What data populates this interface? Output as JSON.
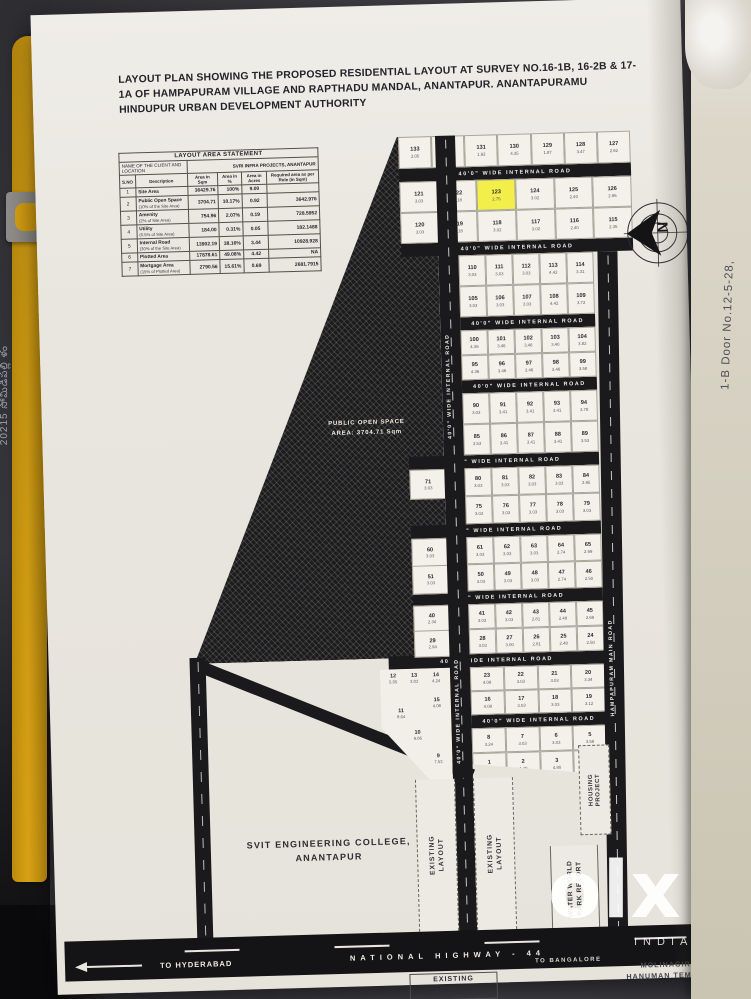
{
  "photo": {
    "left_margin_text": "20215 సోమిడిపల్లి ళం",
    "right_margin_text": "1-B Door No.12-5-28,",
    "watermark": {
      "brand": "olx",
      "country": "INDIA"
    }
  },
  "header": {
    "title": "LAYOUT PLAN SHOWING THE PROPOSED RESIDENTIAL LAYOUT AT SURVEY NO.16-1B, 16-2B & 17-1A OF HAMPAPURAM VILLAGE AND RAPTHADU MANDAL, ANANTAPUR.  ANANTAPURAMU HINDUPUR URBAN DEVELOPMENT AUTHORITY"
  },
  "table": {
    "title": "LAYOUT AREA STATEMENT",
    "client_label": "NAME OF THE CLIENT AND LOCATION",
    "client_value": "SVRI INFRA PROJECTS, ANANTAPUR",
    "columns": [
      "S.NO",
      "Description",
      "Area in Sqm",
      "Area in %",
      "Area in Acres",
      "Required area as per Rule (in Sqm)"
    ],
    "rows": [
      [
        "1",
        "Site Area",
        "36429.76",
        "100%",
        "9.00",
        ""
      ],
      [
        "2",
        "Public Open Space|(10% of the Site Area)",
        "3704.71",
        "10.17%",
        "0.92",
        "3642.976"
      ],
      [
        "3",
        "Amenity|(2% of Site Area)",
        "754.96",
        "2.07%",
        "0.19",
        "728.5952"
      ],
      [
        "4",
        "Utility|(0.5% of Site Area)",
        "184.00",
        "0.31%",
        "0.05",
        "182.1488"
      ],
      [
        "5",
        "Internal Road|(30% of the Site Area)",
        "13902.19",
        "38.16%",
        "3.44",
        "10928.928"
      ],
      [
        "6",
        "Plotted Area",
        "17878.61",
        "49.08%",
        "4.42",
        "NA"
      ],
      [
        "7",
        "Mortgage Area|(15% of Plotted Area)",
        "2790.56",
        "15.61%",
        "0.69",
        "2681.7915"
      ]
    ]
  },
  "plan": {
    "internal_road_label": "40'0\" WIDE INTERNAL ROAD",
    "main_road_label": "HAMPAPURAM MAIN ROAD",
    "open_space_line1": "PUBLIC OPEN SPACE",
    "open_space_line2": "AREA: 3704.71 Sqm",
    "college_line1": "SVIT ENGINEERING COLLEGE,",
    "college_line2": "ANANTAPUR",
    "existing_layout_word1": "EXISTING",
    "existing_layout_word2": "LAYOUT",
    "water_world_line1": "WATER WORLD",
    "water_world_line2": "PARK RESORT",
    "housing_word1": "HOUSING",
    "housing_word2": "PROJECT",
    "temple_line1": "MOLINAGIRI",
    "temple_line2": "HANUMAN TEMPLE",
    "highway_name": "NATIONAL HIGHWAY - 44",
    "to_hyderabad": "TO HYDERABAD",
    "to_bangalore": "TO BANGALORE",
    "compass_letter": "N",
    "highlight_plot": "123",
    "highlight_color": "#f2ee4a",
    "blocks": {
      "b0": [
        "133|2.05",
        "132|1.86",
        "131|1.92",
        "130|4.35",
        "129|1.87",
        "128|3.47",
        "127|2.62"
      ],
      "b1r1": [
        "121|3.03",
        "122|3.18",
        "123|2.75",
        "124|3.02",
        "125|2.40",
        "126|2.86"
      ],
      "b1r2": [
        "120|3.03",
        "119|3.18",
        "118|3.02",
        "117|3.02",
        "116|2.40",
        "115|2.35"
      ],
      "b2r1": [
        "110|3.03",
        "111|3.03",
        "112|3.03",
        "113|4.42",
        "114|3.31"
      ],
      "b2r2": [
        "105|3.03",
        "106|3.03",
        "107|3.03",
        "108|4.42",
        "109|3.72"
      ],
      "b3r1": [
        "100|4.36",
        "101|3.46",
        "102|3.46",
        "103|3.40",
        "104|3.82"
      ],
      "b3r2": [
        "95|4.36",
        "96|3.46",
        "97|3.46",
        "98|3.46",
        "99|3.58"
      ],
      "b4r1": [
        "90|3.03",
        "91|3.41",
        "92|3.41",
        "93|3.41",
        "94|3.78"
      ],
      "b4r2": [
        "85|3.53",
        "86|3.41",
        "87|3.41",
        "88|3.41",
        "89|3.53"
      ],
      "b5r1": [
        "80|3.03",
        "81|3.03",
        "82|3.03",
        "83|3.03",
        "84|2.95"
      ],
      "b5r2": [
        "75|3.03",
        "76|3.03",
        "77|3.03",
        "78|3.03",
        "79|3.03"
      ],
      "b6r1": [
        "61|3.03",
        "62|3.03",
        "63|3.03",
        "64|2.74",
        "65|2.69"
      ],
      "b6r2": [
        "50|3.03",
        "49|3.03",
        "48|3.03",
        "47|2.74",
        "46|2.50"
      ],
      "b7r1": [
        "41|3.03",
        "42|3.03",
        "43|2.81",
        "44|2.48",
        "45|2.69"
      ],
      "b7r2": [
        "28|3.03",
        "27|3.00",
        "26|2.81",
        "25|2.48",
        "24|2.50"
      ],
      "b8r1": [
        "23|4.08",
        "22|3.03",
        "21|3.03",
        "20|3.34"
      ],
      "b8r2": [
        "16|4.08",
        "17|3.03",
        "18|3.03",
        "19|3.12"
      ],
      "b9r1": [
        "8|3.24",
        "7|3.03",
        "6|3.03",
        "5|3.58"
      ],
      "b9r2": [
        "1|3.24",
        "2|4.49",
        "3|4.80",
        "4|5.96"
      ]
    },
    "left_column": [
      "71|3.03",
      "60|3.03",
      "51|3.03",
      "40|2.34",
      "29|2.94"
    ],
    "diagonal_plots": [
      "12|5.05",
      "13|3.03",
      "14|4.24",
      "15|4.08",
      "11|8.64",
      "10|9.06",
      "9|7.53"
    ]
  }
}
